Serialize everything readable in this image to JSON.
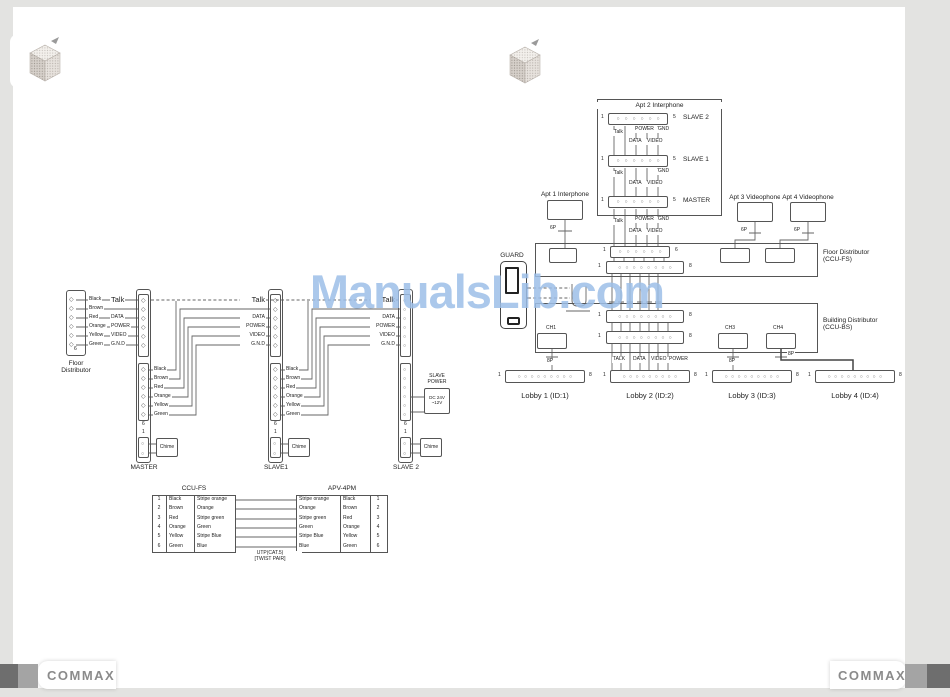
{
  "watermark": "ManualsLib.com",
  "brand": "COMMAX",
  "shared": {
    "colors": [
      "Black",
      "Brown",
      "Red",
      "Orange",
      "Yellow",
      "Green"
    ],
    "signals": [
      "Talk",
      "DATA",
      "POWER",
      "VIDEO",
      "G.N.D"
    ],
    "sig": {
      "talk": "Talk",
      "power": "POWER",
      "gnd": "GND",
      "data": "DATA",
      "video": "VIDEO"
    },
    "bus": [
      "TALK",
      "DATA",
      "VIDEO",
      "POWER"
    ],
    "p6": "6P",
    "p8": "8P",
    "pin1": "1",
    "pin5": "5",
    "pin6": "6",
    "pin8": "8"
  },
  "left_diagram": {
    "floor_distributor": "Floor\nDistributor",
    "units": [
      "MASTER",
      "SLAVE1",
      "SLAVE 2"
    ],
    "chime": "Chime",
    "slave_power_title": "SLAVE\nPOWER",
    "slave_power_value": "DC 24V\n~12V",
    "table": {
      "left_header": "CCU-FS",
      "right_header": "APV-4PM",
      "rows": [
        {
          "n": "1",
          "color": "Black",
          "stripe": "Stripe orange"
        },
        {
          "n": "2",
          "color": "Brown",
          "stripe": "Orange"
        },
        {
          "n": "3",
          "color": "Red",
          "stripe": "Stripe green"
        },
        {
          "n": "4",
          "color": "Orange",
          "stripe": "Green"
        },
        {
          "n": "5",
          "color": "Yellow",
          "stripe": "Stripe Blue"
        },
        {
          "n": "6",
          "color": "Green",
          "stripe": "Blue"
        }
      ],
      "cable_note": "UTP(CAT.5)\n[TWIST PAIR]"
    }
  },
  "right_diagram": {
    "apt2_title": "Apt 2 Interphone",
    "apt2_rows": [
      "SLAVE 2",
      "SLAVE 1",
      "MASTER"
    ],
    "apt1_label": "Apt 1 Interphone",
    "apt3_label": "Apt 3 Videophone",
    "apt4_label": "Apt 4 Videophone",
    "guard_label": "GUARD",
    "floor_distributor": "Floor Distributor\n(CCU-FS)",
    "building_distributor": "Building Distributor\n(CCU-BS)",
    "channels": [
      "CH1",
      "CH3",
      "CH4"
    ],
    "lobbies": [
      "Lobby 1 (ID:1)",
      "Lobby 2 (ID:2)",
      "Lobby 3 (ID:3)",
      "Lobby 4 (ID:4)"
    ]
  }
}
